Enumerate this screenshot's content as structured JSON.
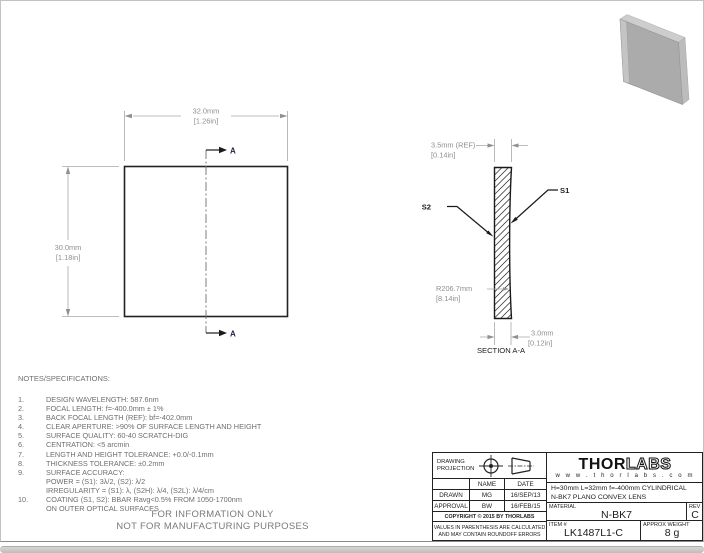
{
  "drawing": {
    "front_view": {
      "width_mm": "32.0mm",
      "width_in": "[1.26in]",
      "height_mm": "30.0mm",
      "height_in": "[1.18in]",
      "section_arrow_label": "A"
    },
    "section_view": {
      "edge_mm": "3.5mm (REF)",
      "edge_in": "[0.14in]",
      "center_mm": "3.0mm",
      "center_in": "[0.12in]",
      "radius_mm": "R206.7mm",
      "radius_in": "[8.14in]",
      "s1": "S1",
      "s2": "S2",
      "caption": "SECTION A-A"
    }
  },
  "notes": {
    "heading": "NOTES/SPECIFICATIONS:",
    "rows": [
      {
        "n": "1.",
        "t": "DESIGN WAVELENGTH: 587.6nm"
      },
      {
        "n": "2.",
        "t": "FOCAL LENGTH: f=-400.0mm ± 1%"
      },
      {
        "n": "3.",
        "t": "BACK FOCAL LENGTH (REF):  bf=-402.0mm"
      },
      {
        "n": "4.",
        "t": "CLEAR APERTURE: >90% OF SURFACE LENGTH AND HEIGHT"
      },
      {
        "n": "5.",
        "t": "SURFACE QUALITY: 60-40 SCRATCH-DIG"
      },
      {
        "n": "6.",
        "t": "CENTRATION: <5 arcmin"
      },
      {
        "n": "7.",
        "t": "LENGTH AND HEIGHT TOLERANCE: +0.0/-0.1mm"
      },
      {
        "n": "8.",
        "t": "THICKNESS TOLERANCE: ±0.2mm"
      },
      {
        "n": "9.",
        "t": "SURFACE ACCURACY:"
      },
      {
        "n": "",
        "t": "POWER = (S1): 3λ/2, (S2): λ/2"
      },
      {
        "n": "",
        "t": "IRREGULARITY = (S1): λ, (S2H): λ/4, (S2L): λ/4/cm"
      },
      {
        "n": "10.",
        "t": "COATING (S1, S2): BBAR Ravg<0.5% FROM 1050-1700nm"
      },
      {
        "n": "",
        "t": "ON OUTER OPTICAL SURFACES"
      }
    ]
  },
  "footer": {
    "line1": "FOR INFORMATION ONLY",
    "line2": "NOT FOR MANUFACTURING PURPOSES"
  },
  "title_block": {
    "projection_label_1": "DRAWING",
    "projection_label_2": "PROJECTION",
    "name_header": "NAME",
    "date_header": "DATE",
    "drawn_label": "DRAWN",
    "drawn_name": "MG",
    "drawn_date": "16/SEP/13",
    "approval_label": "APPROVAL",
    "approval_name": "BW",
    "approval_date": "16/FEB/15",
    "copyright": "COPYRIGHT © 2015 BY THORLABS",
    "disclaimer_line1": "VALUES IN PARENTHESIS ARE CALCULATED",
    "disclaimer_line2": "AND MAY CONTAIN ROUNDOFF ERRORS",
    "logo_thor": "THOR",
    "logo_labs": "LABS",
    "logo_url": "w w w . t h o r l a b s . c o m",
    "description_line1": "H=30mm L=32mm f=-400mm CYLINDRICAL",
    "description_line2": "N-BK7 PLANO CONVEX LENS",
    "material_label": "MATERIAL",
    "material_value": "N-BK7",
    "rev_label": "REV",
    "rev_value": "C",
    "item_label": "ITEM #",
    "item_value": "LK1487L1-C",
    "weight_label": "APPROX WEIGHT",
    "weight_value": "8 g"
  },
  "colors": {
    "line_black": "#1a1a1a",
    "dim_gray": "#8f8f8f",
    "lens_3d_gray": "#ababab"
  }
}
